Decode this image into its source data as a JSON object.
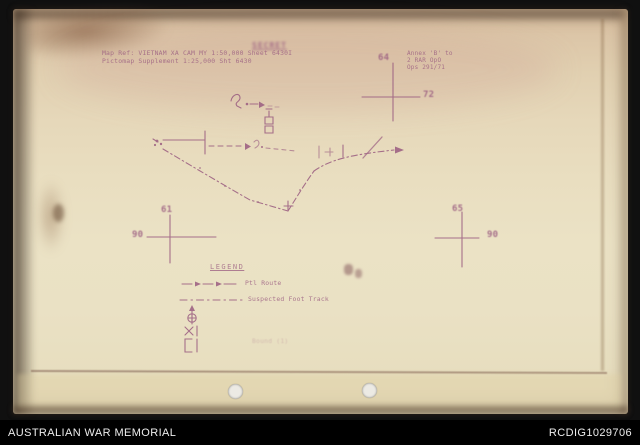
{
  "footer": {
    "institution": "AUSTRALIAN WAR MEMORIAL",
    "item_id": "RCDIG1029706"
  },
  "document": {
    "classification_stamp": "SECRET",
    "map_ref": {
      "line1": "Map Ref: VIETNAM XA CAM MY 1:50,000 Sheet 6430I",
      "line2": "Pictomap Supplement 1:25,000 Sht 6430"
    },
    "annex_block": {
      "line1": "Annex 'B' to",
      "line2": "2 RAR OpO",
      "line3": "Ops 291/71"
    },
    "grid_crosses": {
      "top_right": {
        "easting": "64",
        "northing": "72"
      },
      "left": {
        "easting": "61",
        "northing": "90"
      },
      "right": {
        "easting": "65",
        "northing": "90"
      }
    },
    "legend": {
      "title": "LEGEND",
      "rows": [
        {
          "symbol": "dash-arrow-line",
          "label": "Ptl Route"
        },
        {
          "symbol": "dash-dot-line",
          "label": "Suspected Foot Track"
        },
        {
          "symbol": "circle-cross-stem",
          "label": ""
        },
        {
          "symbol": "x-bar-marker",
          "label": ""
        },
        {
          "symbol": "bracket-marker",
          "label": ""
        }
      ],
      "note": "Bound (1)"
    }
  },
  "colors": {
    "ink": "#9a5c80",
    "paper": "#e9e1c4",
    "footer_bg": "#000000",
    "footer_text": "#ededed"
  }
}
